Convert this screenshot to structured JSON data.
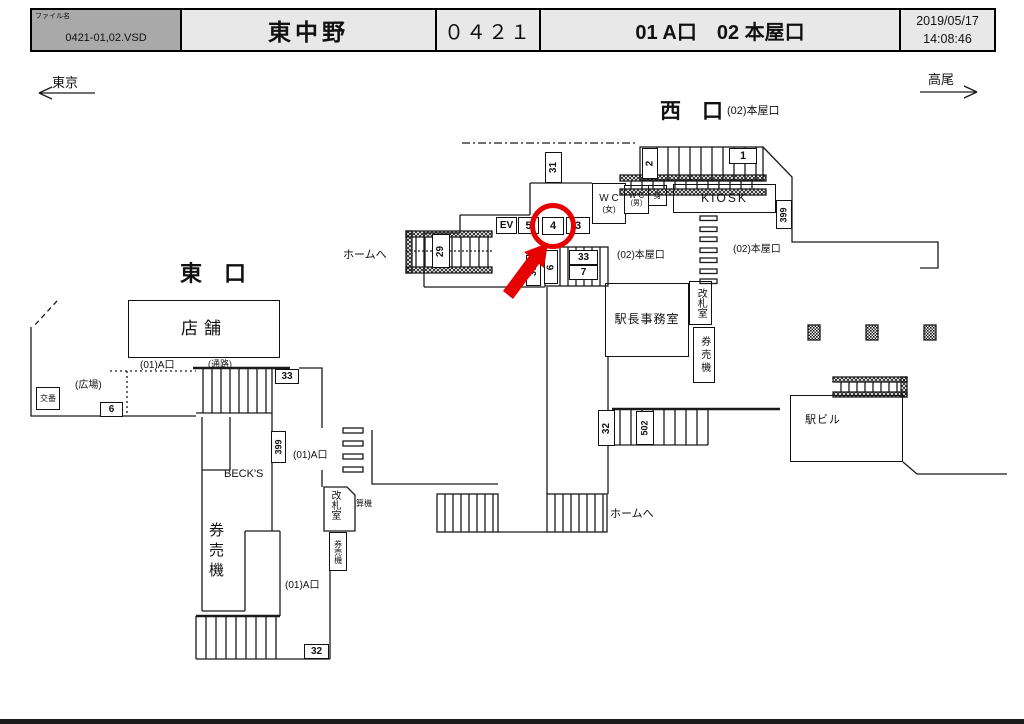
{
  "header": {
    "file_label": "ファイル名",
    "file_name": "0421-01,02.VSD",
    "station_name": "東中野",
    "station_code": "０４２１",
    "exits_title": "01 A口　02 本屋口",
    "date": "2019/05/17",
    "time": "14:08:46"
  },
  "directions": {
    "left": "東京",
    "right": "高尾"
  },
  "areas": {
    "west_exit": "西　口",
    "east_exit": "東　口",
    "honya_exit": "(02)本屋口",
    "a_exit": "(01)A口",
    "passage": "(通路)",
    "plaza": "(広場)",
    "to_platform": "ホームへ"
  },
  "rooms": {
    "shop": "店舗",
    "kiosk": "KIOSK",
    "wc_w_1": "W C",
    "wc_w_2": "(女)",
    "wc_m_1": "W C",
    "wc_m_2": "(男)",
    "wc_acc": "身",
    "office": "駅長事務室",
    "gate_room": "改札室",
    "ticket_machine": "券売機",
    "fare_adjust": "精算機",
    "police": "交番",
    "becks": "BECK'S",
    "station_bldg": "駅ビル"
  },
  "spots": {
    "ev": "EV",
    "s1": "1",
    "s2": "2",
    "s3": "3",
    "s4": "4",
    "s5": "5",
    "s6": "6",
    "s7": "7",
    "s29": "29",
    "s30": "30",
    "s31": "31",
    "s32": "32",
    "s33": "33",
    "s399": "399",
    "s502": "502"
  },
  "colors": {
    "highlight": "#e60000"
  }
}
